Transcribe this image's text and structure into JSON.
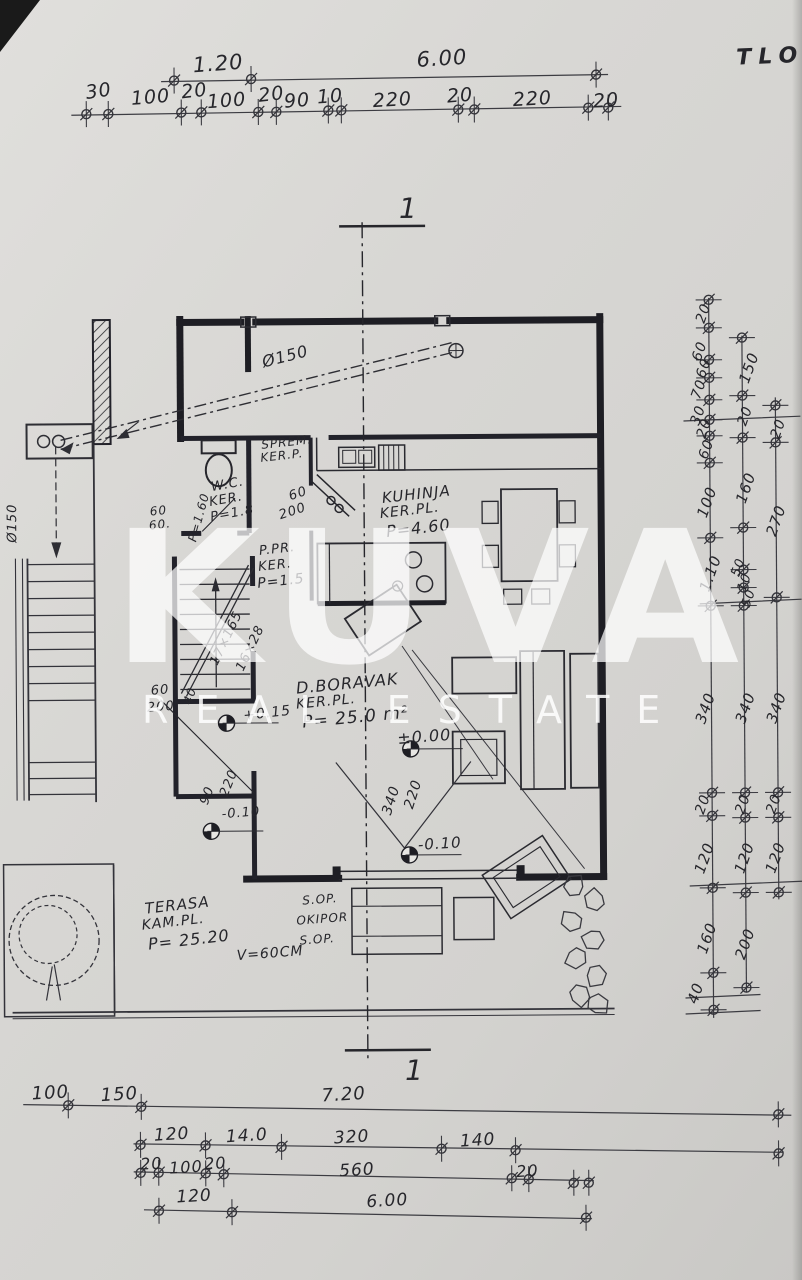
{
  "title": {
    "text": "TLO"
  },
  "watermark": {
    "brand": "KUVA",
    "tagline": "REAL ESTATE"
  },
  "section": {
    "top": "1",
    "bottom": "1"
  },
  "top_dims": {
    "row1": [
      "1.20",
      "6.00"
    ],
    "row2": [
      "30",
      "100",
      "20",
      "100",
      "20",
      "90",
      "10",
      "220",
      "20",
      "220",
      "20"
    ]
  },
  "right_dims": {
    "chain1": [
      "20",
      "60",
      "60",
      "70",
      "30",
      "20",
      "60",
      "100",
      "1.10",
      "340",
      "20",
      "120",
      "160",
      "40"
    ],
    "chain2": [
      "150",
      "20",
      "160",
      "50",
      "10",
      "50",
      "340",
      "20",
      "120",
      "200"
    ],
    "chain3": [
      "20",
      "270",
      "340",
      "20",
      "120"
    ]
  },
  "bottom_dims": {
    "row1": [
      "100",
      "150",
      "7.20"
    ],
    "row2": [
      "120",
      "14.0",
      "320",
      "140"
    ],
    "row3": [
      "20",
      "100",
      "20",
      "560",
      "20"
    ],
    "row4": [
      "120",
      "6.00"
    ]
  },
  "rooms": {
    "kitchen": {
      "name": "KUHINJA",
      "floor": "KER.PL.",
      "area": "P=4.60"
    },
    "living": {
      "name": "D.BORAVAK",
      "floor": "KER.PL.",
      "area": "P= 25.0 m²"
    },
    "terrace": {
      "name": "TERASA",
      "floor": "KAM.PL.",
      "area": "P= 25.20"
    },
    "wc": {
      "name": "W.C.",
      "floor": "KER.",
      "area": "P=1.8"
    },
    "storage": {
      "name": "SPREM.",
      "floor": "KER.P."
    },
    "vestibule": {
      "name": "P.PR.",
      "floor": "KER.",
      "area": "P=1.5"
    }
  },
  "levels": {
    "zero": "±0.00",
    "minus10_center": "-0.10",
    "plus15": "+0.15",
    "minus10_left": "-0.10"
  },
  "annotations": {
    "pipe_diag": "Ø150",
    "pipe_left": "Ø150",
    "stairs_riser": "17×165",
    "stairs_tread": "16×28",
    "stairs_width": "40",
    "wc_door_w": "60",
    "wc_door_h": "200",
    "left60a": "60",
    "left60b": "60.",
    "p160": "P=1.60",
    "stack60": "60",
    "stack200": "200",
    "door90": "90",
    "door220": "220",
    "open340": "340",
    "open220": "220",
    "sop1": "S.OP.",
    "okipor": "OKIPOR",
    "sop2": "S.OP.",
    "height": "V=60CM"
  }
}
